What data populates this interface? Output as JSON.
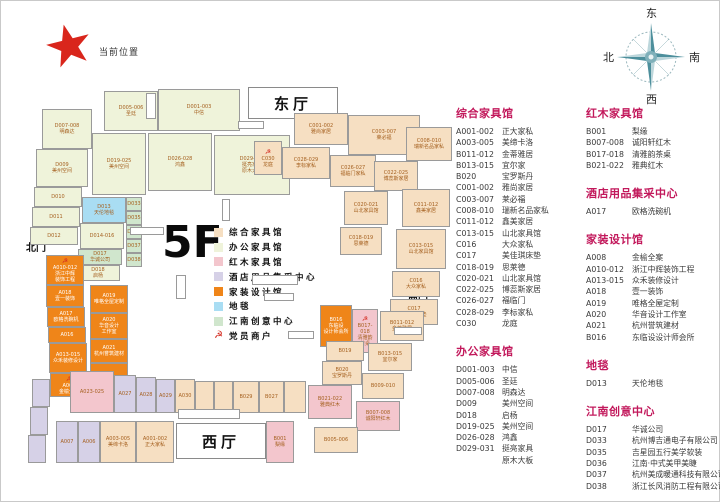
{
  "current_location": {
    "label": "当前位置"
  },
  "compass": {
    "east": "东",
    "west": "西",
    "south": "南",
    "north": "北"
  },
  "floor": {
    "label": "5F"
  },
  "halls": {
    "east": "东厅",
    "west": "西厅"
  },
  "gates": {
    "north": "北门",
    "south": "南门"
  },
  "palette": {
    "zh": "#f6dfc2",
    "bg": "#eff3da",
    "hm": "#f3c6cd",
    "jd": "#d6d1e7",
    "jz": "#ef8519",
    "dt": "#a9ddf3",
    "cn": "#d0e6cd",
    "header": "#c2185b",
    "cell_text": "#a5601f",
    "emblem": "#d42b20",
    "star": "#d9261c"
  },
  "legend": {
    "items": [
      {
        "label": "综合家具馆",
        "type": "zh"
      },
      {
        "label": "办公家具馆",
        "type": "bg"
      },
      {
        "label": "红木家具馆",
        "type": "hm"
      },
      {
        "label": "酒店用品集采中心",
        "type": "jd"
      },
      {
        "label": "家装设计馆",
        "type": "jz"
      },
      {
        "label": "地毯",
        "type": "dt"
      },
      {
        "label": "江南创意中心",
        "type": "cn"
      },
      {
        "label": "党员商户",
        "type": "emblem"
      }
    ]
  },
  "directory": {
    "columns": [
      [
        0,
        1
      ],
      [
        2,
        3,
        4,
        5,
        6
      ]
    ],
    "sections": [
      {
        "title": "综合家具馆",
        "items": [
          [
            "A001-002",
            "正大家私"
          ],
          [
            "A003-005",
            "美缔卡洛"
          ],
          [
            "B011-012",
            "金蒂雅居"
          ],
          [
            "B013-015",
            "宜尔家"
          ],
          [
            "B020",
            "宝罗斯丹"
          ],
          [
            "C001-002",
            "雅尚家居"
          ],
          [
            "C003-007",
            "莱必福"
          ],
          [
            "C008-010",
            "瑞新名品家私"
          ],
          [
            "C011-012",
            "鑫美家居"
          ],
          [
            "C013-015",
            "山北家具馆"
          ],
          [
            "C016",
            "大众家私"
          ],
          [
            "C017",
            "美佳琪床垫"
          ],
          [
            "C018-019",
            "思莱德"
          ],
          [
            "C020-021",
            "山北家具馆"
          ],
          [
            "C022-025",
            "博蕊斯家居"
          ],
          [
            "C026-027",
            "福临门"
          ],
          [
            "C028-029",
            "李标家私"
          ],
          [
            "C030",
            "龙庭"
          ]
        ]
      },
      {
        "title": "办公家具馆",
        "items": [
          [
            "D001-003",
            "中信"
          ],
          [
            "D005-006",
            "圣廷"
          ],
          [
            "D007-008",
            "明森达"
          ],
          [
            "D009",
            "美州空间"
          ],
          [
            "D018",
            "启杨"
          ],
          [
            "D019-025",
            "美州空间"
          ],
          [
            "D026-028",
            "鸿鑫"
          ],
          [
            "D029-031",
            "挺亮家具\n原木大板"
          ]
        ]
      },
      {
        "title": "红木家具馆",
        "items": [
          [
            "B001",
            "梨缘"
          ],
          [
            "B007-008",
            "诚阳轩红木"
          ],
          [
            "B017-018",
            "清雅韵茶桌"
          ],
          [
            "B021-022",
            "雅典红木"
          ]
        ]
      },
      {
        "title": "酒店用品集采中心",
        "items": [
          [
            "A017",
            "欧格洗碗机"
          ]
        ]
      },
      {
        "title": "家装设计馆",
        "items": [
          [
            "A008",
            "金榆全案"
          ],
          [
            "A010-012",
            "浙江中辉装饰工程"
          ],
          [
            "A013-015",
            "众禾装修设计"
          ],
          [
            "A018",
            "壹一装饰"
          ],
          [
            "A019",
            "唯格全屋定制"
          ],
          [
            "A020",
            "华音设计工作室"
          ],
          [
            "A021",
            "杭州誉筑建材"
          ],
          [
            "B016",
            "东临设设计师会所"
          ]
        ]
      },
      {
        "title": "地毯",
        "items": [
          [
            "D013",
            "天伦地毯"
          ]
        ]
      },
      {
        "title": "江南创意中心",
        "items": [
          [
            "D017",
            "华诚公司"
          ],
          [
            "D033",
            "杭州博吉通电子有限公司"
          ],
          [
            "D035",
            "吉星园五行美学软装"
          ],
          [
            "D036",
            "江南·中式美甲美睫"
          ],
          [
            "D037",
            "杭州美成暖通科技有限公司"
          ],
          [
            "D038",
            "浙江长风消防工程有限公司"
          ]
        ]
      }
    ]
  },
  "floor_plan": {
    "cells": [
      {
        "c": "D007-008",
        "n": "明森达",
        "t": "bg",
        "b": [
          16,
          30,
          50,
          40
        ]
      },
      {
        "c": "D005-006",
        "n": "圣廷",
        "t": "bg",
        "b": [
          78,
          12,
          54,
          40
        ]
      },
      {
        "c": "D001-003",
        "n": "中信",
        "t": "bg",
        "b": [
          132,
          10,
          82,
          42
        ]
      },
      {
        "c": "D009",
        "n": "美州空间",
        "t": "bg",
        "b": [
          10,
          70,
          52,
          38
        ]
      },
      {
        "c": "D019-025",
        "n": "美州空间",
        "t": "bg",
        "b": [
          66,
          54,
          54,
          62
        ]
      },
      {
        "c": "D026-028",
        "n": "鸿鑫",
        "t": "bg",
        "b": [
          122,
          54,
          64,
          58
        ]
      },
      {
        "c": "D029-031",
        "n": "挺亮家具\n原木大板",
        "t": "bg",
        "b": [
          188,
          56,
          76,
          60
        ]
      },
      {
        "c": "D010",
        "t": "bg",
        "b": [
          8,
          108,
          48,
          20
        ]
      },
      {
        "c": "D011",
        "t": "bg",
        "b": [
          6,
          128,
          48,
          20
        ]
      },
      {
        "c": "D012",
        "t": "bg",
        "b": [
          4,
          148,
          48,
          18
        ]
      },
      {
        "c": "D013",
        "n": "天伦地毯",
        "t": "dt",
        "b": [
          56,
          118,
          44,
          26
        ]
      },
      {
        "c": "D014-016",
        "t": "bg",
        "b": [
          54,
          144,
          44,
          26
        ]
      },
      {
        "c": "D017",
        "n": "华诚公司",
        "t": "cn",
        "b": [
          52,
          170,
          44,
          16
        ]
      },
      {
        "c": "D018",
        "n": "启杨",
        "t": "bg",
        "b": [
          50,
          186,
          44,
          16
        ]
      },
      {
        "c": "D033",
        "t": "cn",
        "b": [
          100,
          118,
          16,
          14
        ]
      },
      {
        "c": "D035",
        "t": "cn",
        "b": [
          100,
          132,
          16,
          14
        ]
      },
      {
        "c": "D036",
        "t": "cn",
        "b": [
          100,
          146,
          16,
          14
        ]
      },
      {
        "c": "D037",
        "t": "cn",
        "b": [
          100,
          160,
          16,
          14
        ]
      },
      {
        "c": "D038",
        "t": "cn",
        "b": [
          100,
          174,
          16,
          14
        ]
      },
      {
        "c": "A010-012",
        "n": "浙江中辉\n装饰工程",
        "t": "jz",
        "e": true,
        "b": [
          20,
          176,
          38,
          30
        ]
      },
      {
        "c": "A018",
        "n": "壹一装饰",
        "t": "jz",
        "b": [
          20,
          206,
          38,
          22
        ]
      },
      {
        "c": "A017",
        "n": "欧格洗碗机",
        "t": "jz",
        "b": [
          21,
          228,
          38,
          20
        ]
      },
      {
        "c": "A016",
        "t": "jz",
        "b": [
          22,
          248,
          38,
          16
        ]
      },
      {
        "c": "A013-015",
        "n": "众禾装修设计",
        "t": "jz",
        "b": [
          23,
          264,
          38,
          30
        ]
      },
      {
        "c": "A008",
        "n": "金榆全案",
        "t": "jz",
        "e": true,
        "b": [
          24,
          294,
          38,
          24
        ]
      },
      {
        "c": "A019",
        "n": "唯格全屋定制",
        "t": "jz",
        "b": [
          64,
          206,
          38,
          28
        ]
      },
      {
        "c": "A020",
        "n": "华音设计\n工作室",
        "t": "jz",
        "b": [
          64,
          234,
          38,
          26
        ]
      },
      {
        "c": "A021",
        "n": "杭州誉筑建材",
        "t": "jz",
        "b": [
          64,
          260,
          38,
          24
        ]
      },
      {
        "c": "",
        "t": "jz",
        "b": [
          64,
          284,
          38,
          18
        ]
      },
      {
        "c": "",
        "t": "jd",
        "b": [
          6,
          300,
          18,
          28
        ]
      },
      {
        "c": "",
        "t": "jd",
        "b": [
          4,
          328,
          18,
          28
        ]
      },
      {
        "c": "",
        "t": "jd",
        "b": [
          2,
          356,
          18,
          28
        ]
      },
      {
        "c": "C001-002",
        "n": "雅尚家居",
        "t": "zh",
        "b": [
          268,
          34,
          54,
          32
        ]
      },
      {
        "c": "C003-007",
        "n": "莱必福",
        "t": "zh",
        "b": [
          322,
          36,
          72,
          40
        ]
      },
      {
        "c": "C030",
        "n": "龙庭",
        "t": "zh",
        "e": true,
        "b": [
          228,
          62,
          28,
          34
        ]
      },
      {
        "c": "C028-029",
        "n": "李标家私",
        "t": "zh",
        "b": [
          256,
          68,
          48,
          32
        ]
      },
      {
        "c": "C026-027",
        "n": "福临门家私",
        "t": "zh",
        "b": [
          304,
          76,
          46,
          32
        ]
      },
      {
        "c": "C022-025",
        "n": "博蕊斯家居",
        "t": "zh",
        "b": [
          348,
          82,
          44,
          30
        ]
      },
      {
        "c": "C008-010",
        "n": "瑞新名品家私",
        "t": "zh",
        "b": [
          380,
          48,
          46,
          34
        ]
      },
      {
        "c": "C011-012",
        "n": "鑫美家居",
        "t": "zh",
        "b": [
          376,
          110,
          48,
          38
        ]
      },
      {
        "c": "C013-015",
        "n": "山北家具馆",
        "t": "zh",
        "b": [
          370,
          150,
          50,
          40
        ]
      },
      {
        "c": "C016",
        "n": "大众家私",
        "t": "zh",
        "b": [
          366,
          192,
          48,
          26
        ]
      },
      {
        "c": "C017",
        "n": "美佳琪床垫",
        "t": "zh",
        "b": [
          364,
          220,
          48,
          26
        ]
      },
      {
        "c": "C020-021",
        "n": "山北家具馆",
        "t": "zh",
        "b": [
          318,
          112,
          44,
          34
        ]
      },
      {
        "c": "C018-019",
        "n": "思莱德",
        "t": "zh",
        "b": [
          314,
          148,
          42,
          28
        ]
      },
      {
        "c": "B016",
        "n": "东临设\n设计师会所",
        "t": "jz",
        "b": [
          294,
          226,
          32,
          42
        ]
      },
      {
        "c": "B017-018",
        "n": "清雅韵\n茶桌",
        "t": "hm",
        "e": true,
        "b": [
          326,
          230,
          26,
          44
        ]
      },
      {
        "c": "B011-012",
        "n": "金蒂雅居",
        "t": "zh",
        "b": [
          354,
          232,
          44,
          30
        ]
      },
      {
        "c": "B013-015",
        "n": "宜尔家",
        "t": "zh",
        "b": [
          342,
          264,
          44,
          28
        ]
      },
      {
        "c": "B019",
        "t": "zh",
        "b": [
          300,
          262,
          38,
          20
        ]
      },
      {
        "c": "B020",
        "n": "宝罗斯丹",
        "t": "zh",
        "b": [
          296,
          282,
          40,
          24
        ]
      },
      {
        "c": "B021-022",
        "n": "雅典红木",
        "t": "hm",
        "b": [
          282,
          306,
          44,
          34
        ]
      },
      {
        "c": "B009-010",
        "t": "zh",
        "b": [
          336,
          294,
          42,
          26
        ]
      },
      {
        "c": "B007-008",
        "n": "诚阳轩红木",
        "t": "hm",
        "b": [
          330,
          322,
          44,
          30
        ]
      },
      {
        "c": "B005-006",
        "t": "zh",
        "b": [
          288,
          348,
          44,
          26
        ]
      },
      {
        "c": "A023-025",
        "t": "hm",
        "b": [
          44,
          292,
          44,
          42
        ]
      },
      {
        "c": "A027",
        "t": "jd",
        "b": [
          88,
          296,
          22,
          38
        ]
      },
      {
        "c": "A028",
        "t": "jd",
        "b": [
          110,
          298,
          20,
          36
        ]
      },
      {
        "c": "A029",
        "t": "jd",
        "b": [
          130,
          300,
          19,
          34
        ]
      },
      {
        "c": "A030",
        "t": "zh",
        "b": [
          149,
          300,
          20,
          34
        ]
      },
      {
        "c": "",
        "t": "zh",
        "b": [
          169,
          302,
          19,
          32
        ]
      },
      {
        "c": "",
        "t": "zh",
        "b": [
          188,
          302,
          19,
          32
        ]
      },
      {
        "c": "B029",
        "t": "zh",
        "b": [
          207,
          302,
          26,
          32
        ]
      },
      {
        "c": "B027",
        "t": "zh",
        "b": [
          233,
          302,
          25,
          32
        ]
      },
      {
        "c": "",
        "t": "zh",
        "b": [
          258,
          302,
          22,
          32
        ]
      },
      {
        "c": "A007",
        "t": "jd",
        "b": [
          30,
          342,
          22,
          42
        ]
      },
      {
        "c": "A006",
        "t": "jd",
        "b": [
          52,
          342,
          22,
          42
        ]
      },
      {
        "c": "A003-005",
        "n": "美缔卡洛",
        "t": "zh",
        "b": [
          74,
          342,
          36,
          42
        ]
      },
      {
        "c": "A001-002",
        "n": "正大家私",
        "t": "zh",
        "b": [
          110,
          342,
          38,
          42
        ]
      },
      {
        "c": "B001",
        "n": "梨缘",
        "t": "hm",
        "b": [
          240,
          342,
          28,
          42
        ]
      }
    ],
    "facilities": [
      [
        212,
        42,
        26,
        8
      ],
      [
        104,
        148,
        34,
        8
      ],
      [
        150,
        196,
        10,
        24
      ],
      [
        226,
        196,
        46,
        10
      ],
      [
        238,
        214,
        30,
        8
      ],
      [
        152,
        330,
        62,
        10
      ],
      [
        262,
        252,
        26,
        8
      ],
      [
        368,
        248,
        28,
        8
      ],
      [
        120,
        14,
        10,
        26
      ],
      [
        196,
        120,
        8,
        22
      ]
    ],
    "halls": {
      "east_box": [
        222,
        8,
        88,
        30
      ],
      "west_box": [
        150,
        344,
        88,
        34
      ]
    },
    "gate_pos": {
      "north": [
        0,
        160
      ],
      "south": [
        382,
        212
      ]
    }
  }
}
